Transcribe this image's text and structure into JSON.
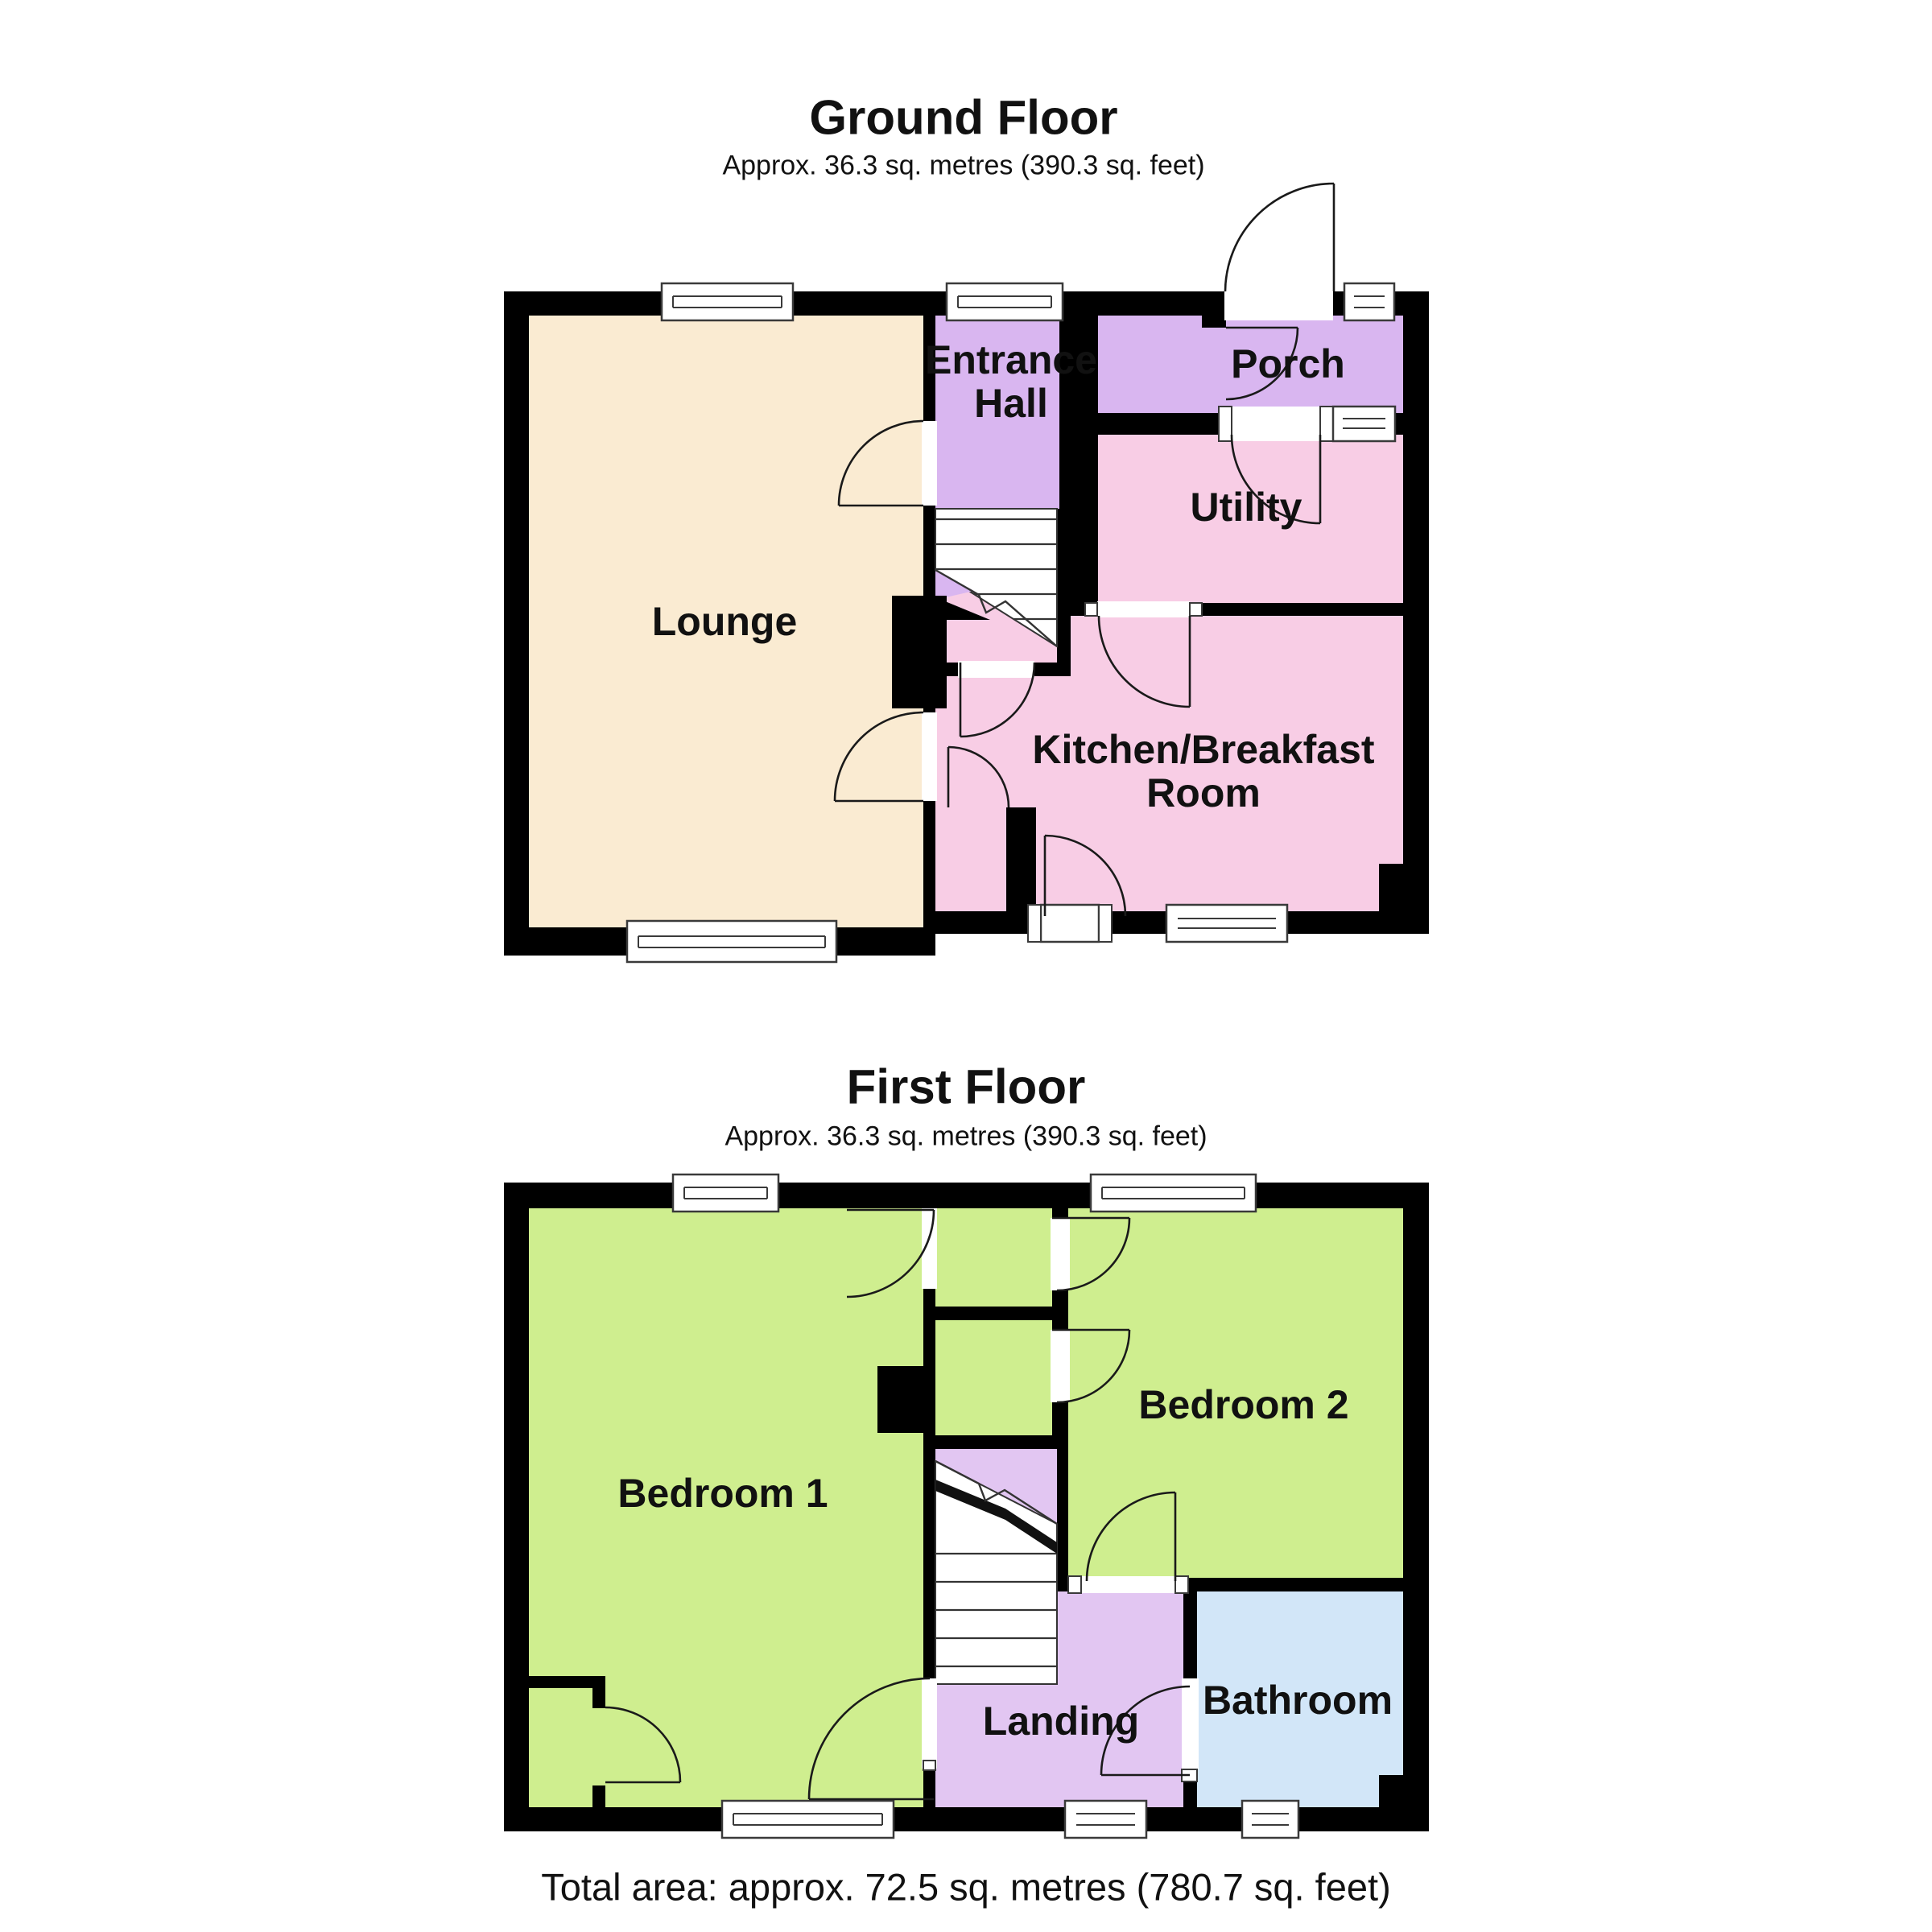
{
  "ground_floor": {
    "title": "Ground Floor",
    "subtitle": "Approx. 36.3 sq. metres (390.3 sq. feet)",
    "rooms": {
      "lounge": "Lounge",
      "entrance_hall": "Entrance\nHall",
      "porch": "Porch",
      "utility": "Utility",
      "kitchen": "Kitchen/Breakfast\nRoom"
    }
  },
  "first_floor": {
    "title": "First Floor",
    "subtitle": "Approx. 36.3 sq. metres (390.3 sq. feet)",
    "rooms": {
      "bedroom1": "Bedroom 1",
      "bedroom2": "Bedroom 2",
      "landing": "Landing",
      "bathroom": "Bathroom"
    }
  },
  "footer": {
    "total_area": "Total area: approx. 72.5 sq. metres (780.7 sq. feet)"
  },
  "colors": {
    "wall": "#000000",
    "lounge": "#FAEBD2",
    "hall": "#D9B6F0",
    "porch": "#D9B6F0",
    "utility": "#F8CDE5",
    "kitchen": "#F8CDE5",
    "bedroom": "#CFEE8F",
    "bathroom": "#D2E6F8",
    "landing": "#E2C6F2"
  }
}
